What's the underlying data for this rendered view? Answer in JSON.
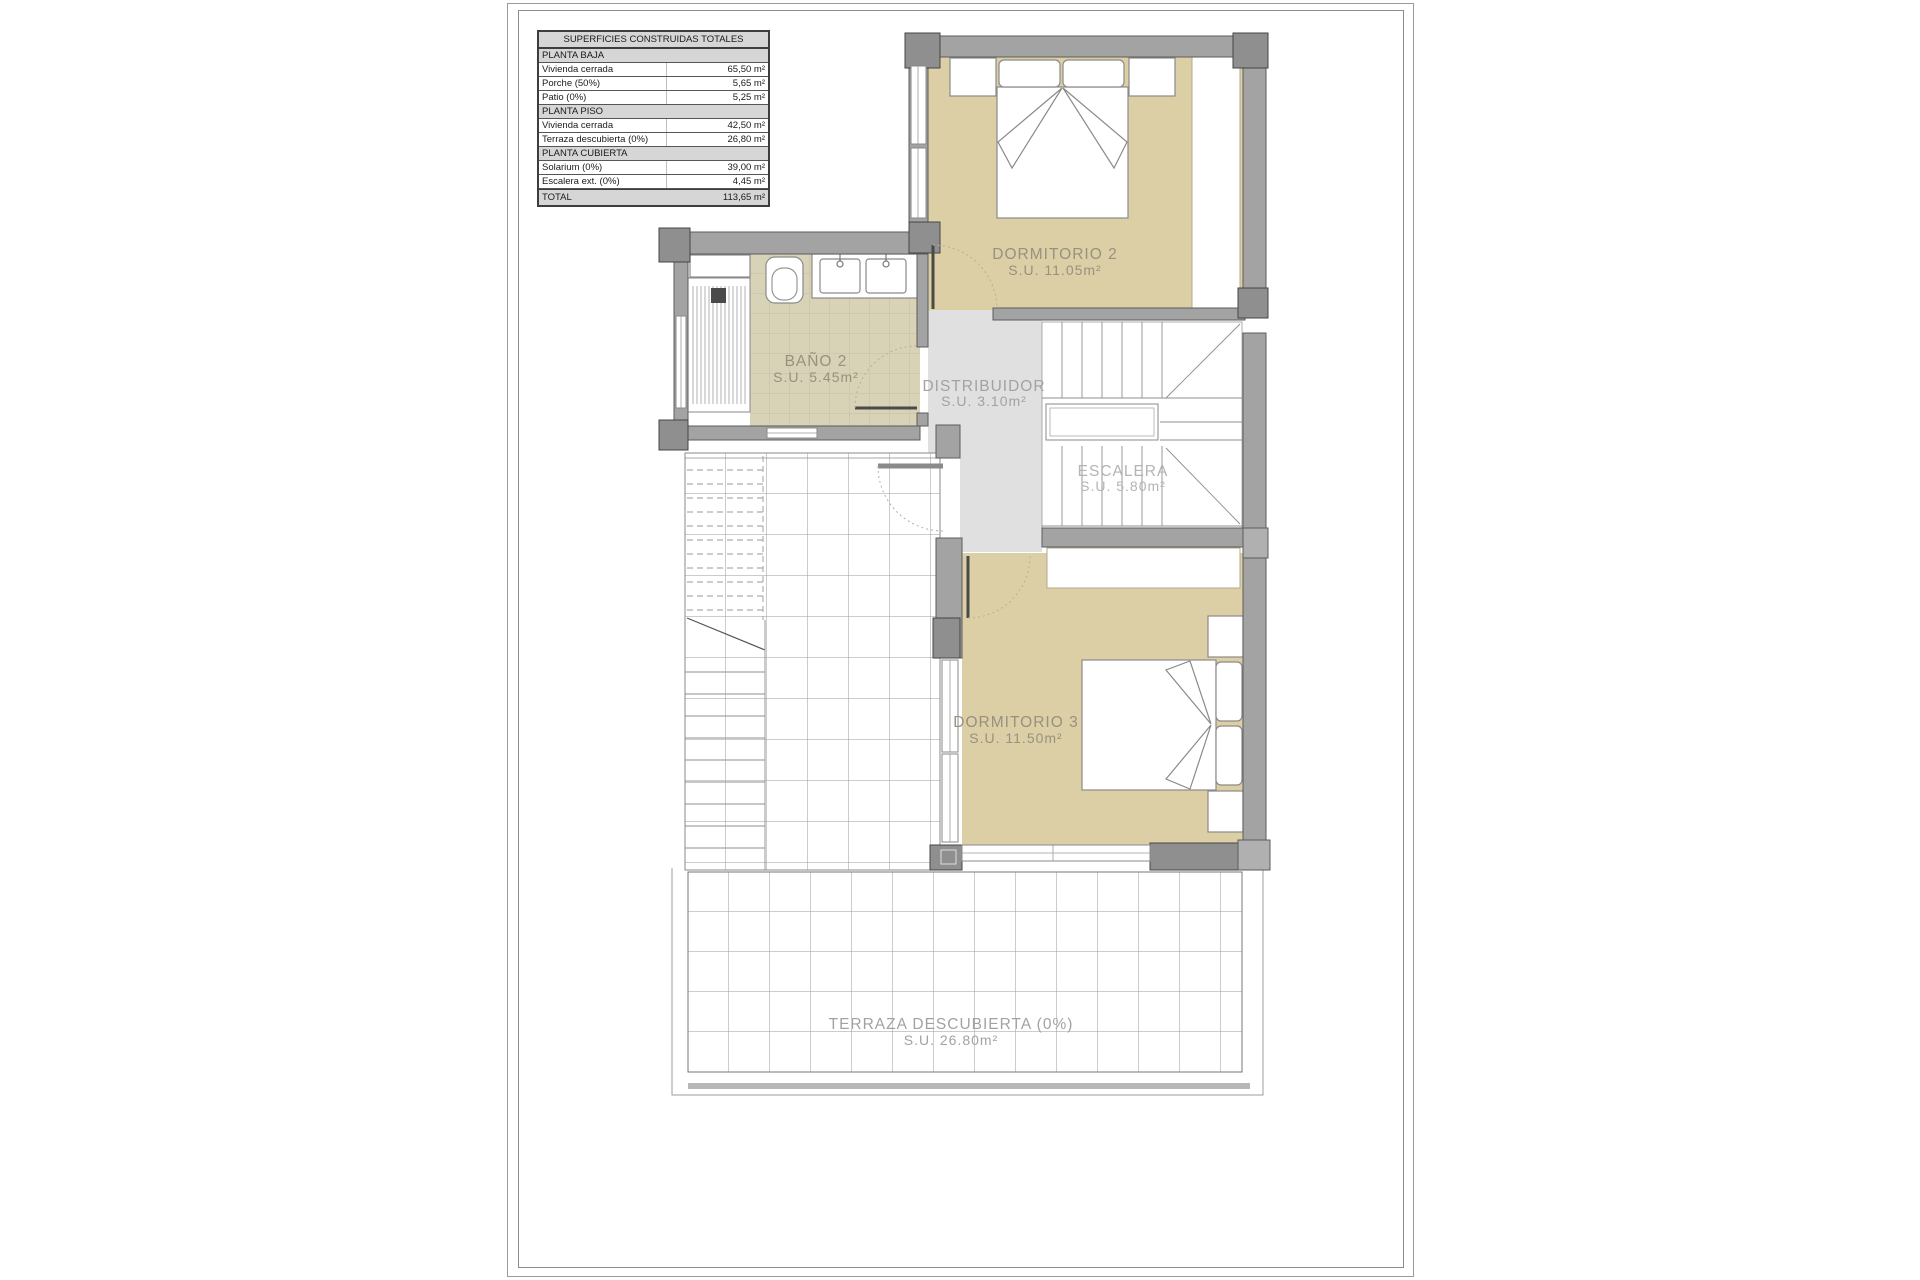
{
  "table": {
    "title": "SUPERFICIES CONSTRUIDAS TOTALES",
    "rows": [
      {
        "type": "section",
        "label": "PLANTA BAJA",
        "value": ""
      },
      {
        "type": "data",
        "label": "Vivienda cerrada",
        "value": "65,50 m²"
      },
      {
        "type": "data",
        "label": "Porche (50%)",
        "value": "5,65 m²"
      },
      {
        "type": "data",
        "label": "Patio (0%)",
        "value": "5,25 m²"
      },
      {
        "type": "section",
        "label": "PLANTA PISO",
        "value": ""
      },
      {
        "type": "data",
        "label": "Vivienda cerrada",
        "value": "42,50 m²"
      },
      {
        "type": "data",
        "label": "Terraza descubierta (0%)",
        "value": "26,80 m²"
      },
      {
        "type": "section",
        "label": "PLANTA CUBIERTA",
        "value": ""
      },
      {
        "type": "data",
        "label": "Solarium (0%)",
        "value": "39,00 m²"
      },
      {
        "type": "data",
        "label": "Escalera ext. (0%)",
        "value": "4,45 m²"
      },
      {
        "type": "total",
        "label": "TOTAL",
        "value": "113,65 m²"
      }
    ]
  },
  "rooms": {
    "dormitorio2": {
      "name": "DORMITORIO 2",
      "area": "S.U. 11.05m²"
    },
    "bano2": {
      "name": "BAÑO 2",
      "area": "S.U. 5.45m²"
    },
    "distribuidor": {
      "name": "DISTRIBUIDOR",
      "area": "S.U. 3.10m²"
    },
    "escalera": {
      "name": "ESCALERA",
      "area": "S.U. 5.80m²"
    },
    "dormitorio3": {
      "name": "DORMITORIO 3",
      "area": "S.U. 11.50m²"
    },
    "terraza": {
      "name": "TERRAZA DESCUBIERTA (0%)",
      "area": "S.U. 26.80m²"
    }
  },
  "colors": {
    "room_fill": "#dccfa6",
    "bath_tile": "#d8d2b7",
    "bath_tile_line": "#c5bfa3",
    "hall_fill": "#e0e0e0",
    "wall": "#a3a3a3",
    "pillar": "#8f8f8f",
    "grid_line": "#9a9a9a",
    "label_text": "#97917f"
  }
}
